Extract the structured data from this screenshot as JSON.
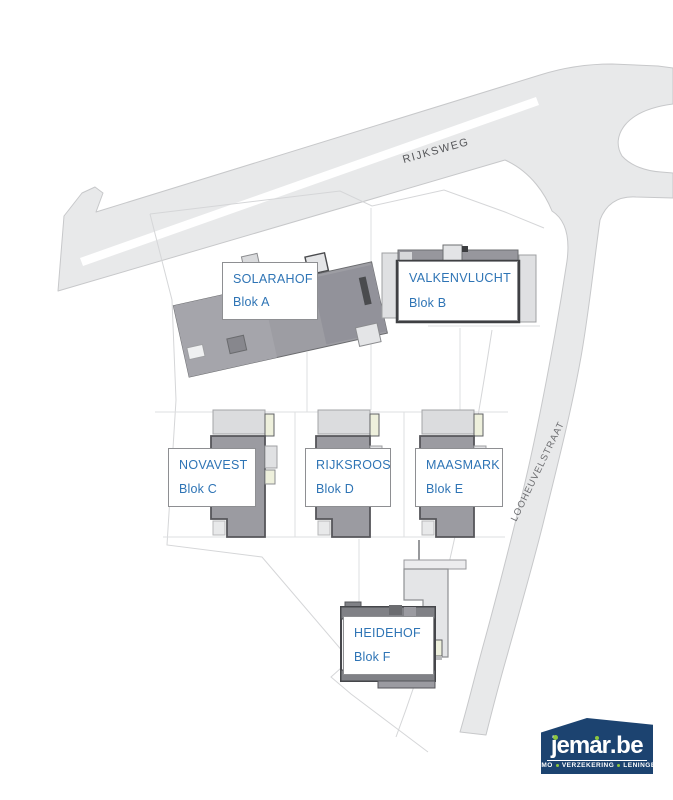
{
  "plan": {
    "road_labels": {
      "main": "RIJKSWEG",
      "side": "LOOHEUVELSTRAAT"
    },
    "blocks": [
      {
        "name": "SOLARAHOF",
        "blok": "Blok A"
      },
      {
        "name": "VALKENVLUCHT",
        "blok": "Blok B"
      },
      {
        "name": "NOVAVEST",
        "blok": "Blok C"
      },
      {
        "name": "RIJKSROOS",
        "blok": "Blok D"
      },
      {
        "name": "MAASMARK",
        "blok": "Blok E"
      },
      {
        "name": "HEIDEHOF",
        "blok": "Blok F"
      }
    ]
  },
  "logo": {
    "brand": "jemar",
    "suffix": ".be",
    "tagline_parts": [
      "IMMO",
      "VERZEKERING",
      "LENINGEN"
    ]
  },
  "colors": {
    "label_text": "#2e74b5",
    "road_fill": "#e8e9ea",
    "road_edge": "#c7c8ca",
    "building_gray": "#9b9ba1",
    "building_dark": "#55565a",
    "building_light": "#e3e4e6",
    "cream_accent": "#eef0dc",
    "logo_navy": "#1c4370",
    "logo_green": "#8dc63f"
  }
}
